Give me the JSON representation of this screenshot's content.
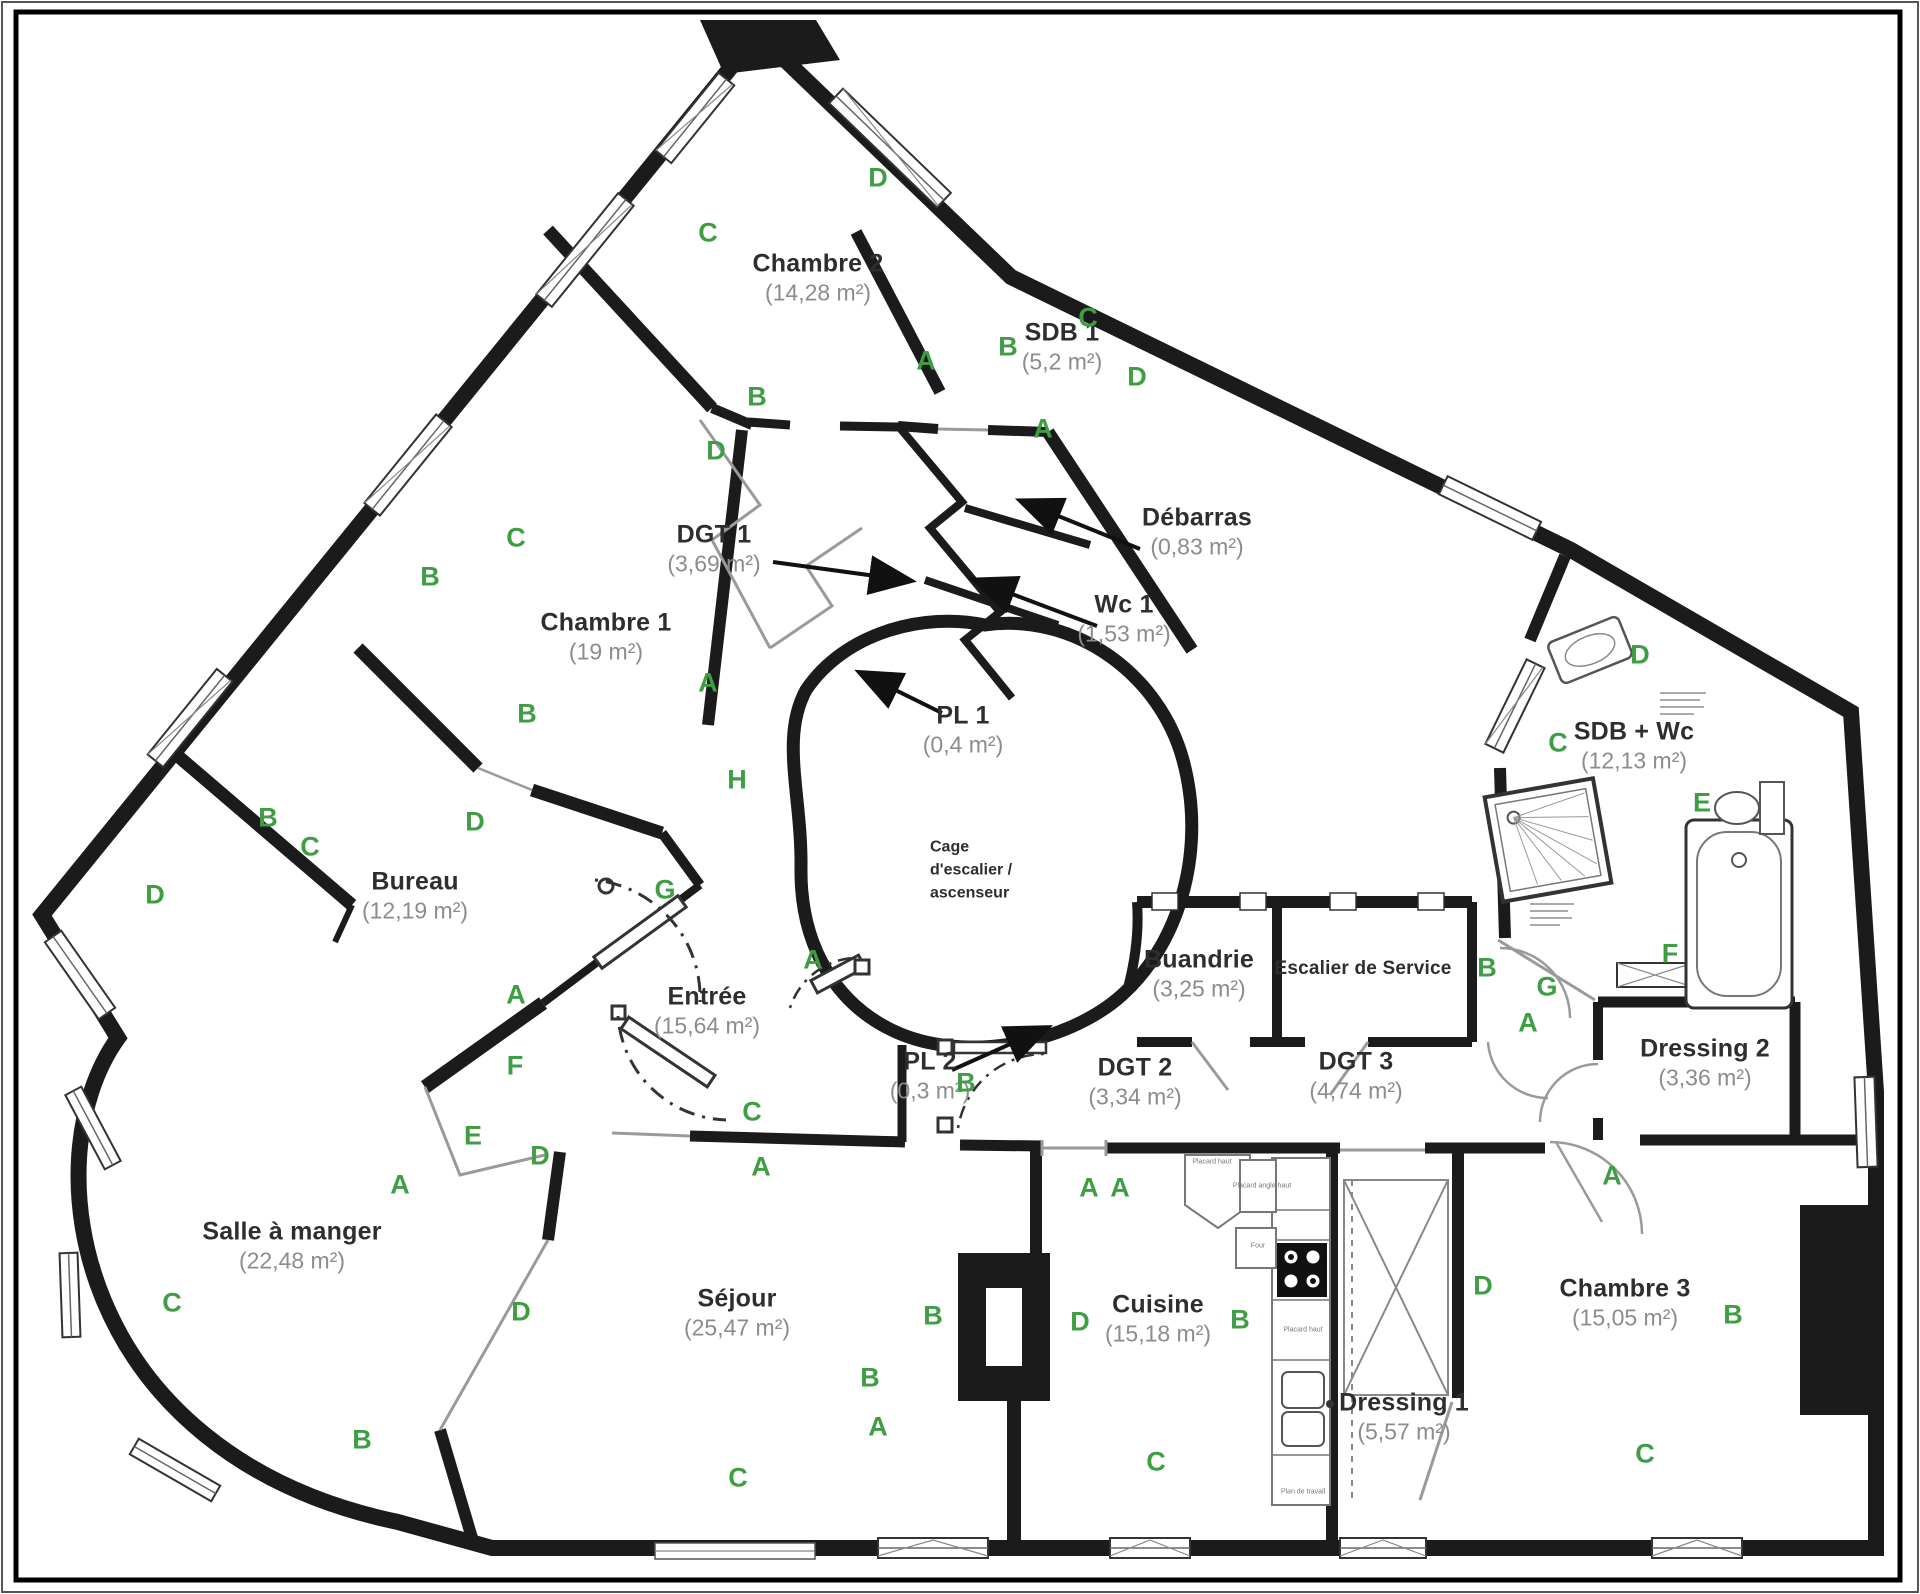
{
  "plan": {
    "title": "Plan d'appartement",
    "colors": {
      "wall": "#1b1b1b",
      "thin_line": "#999999",
      "letter_green": "#3f9e44",
      "room_title": "#2e2e2e",
      "room_area": "#8c8c8c",
      "arrow": "#111111"
    }
  },
  "stair_core": {
    "lines": [
      "Cage",
      "d'escalier /",
      "ascenseur"
    ],
    "x": 930,
    "y": 870
  },
  "rooms": [
    {
      "name": "Chambre 2",
      "area": "(14,28 m²)",
      "x": 818,
      "y": 278
    },
    {
      "name": "SDB 1",
      "area": "(5,2 m²)",
      "x": 1062,
      "y": 347
    },
    {
      "name": "Chambre 1",
      "area": "(19 m²)",
      "x": 606,
      "y": 637
    },
    {
      "name": "DGT 1",
      "area": "(3,69 m²)",
      "x": 714,
      "y": 549
    },
    {
      "name": "Débarras",
      "area": "(0,83 m²)",
      "x": 1197,
      "y": 532
    },
    {
      "name": "Wc 1",
      "area": "(1,53 m²)",
      "x": 1124,
      "y": 619
    },
    {
      "name": "PL 1",
      "area": "(0,4 m²)",
      "x": 963,
      "y": 730
    },
    {
      "name": "SDB + Wc",
      "area": "(12,13 m²)",
      "x": 1634,
      "y": 746
    },
    {
      "name": "Bureau",
      "area": "(12,19 m²)",
      "x": 415,
      "y": 896
    },
    {
      "name": "Entrée",
      "area": "(15,64 m²)",
      "x": 707,
      "y": 1011
    },
    {
      "name": "Buandrie",
      "area": "(3,25 m²)",
      "x": 1199,
      "y": 974
    },
    {
      "name": "Escalier de Service",
      "area": "",
      "x": 1363,
      "y": 969,
      "small": true
    },
    {
      "name": "PL 2",
      "area": "(0,3 m²)",
      "x": 930,
      "y": 1076
    },
    {
      "name": "DGT 2",
      "area": "(3,34 m²)",
      "x": 1135,
      "y": 1082
    },
    {
      "name": "DGT 3",
      "area": "(4,74 m²)",
      "x": 1356,
      "y": 1076
    },
    {
      "name": "Dressing 2",
      "area": "(3,36 m²)",
      "x": 1705,
      "y": 1063
    },
    {
      "name": "Salle à manger",
      "area": "(22,48 m²)",
      "x": 292,
      "y": 1246
    },
    {
      "name": "Séjour",
      "area": "(25,47 m²)",
      "x": 737,
      "y": 1313
    },
    {
      "name": "Cuisine",
      "area": "(15,18 m²)",
      "x": 1158,
      "y": 1319
    },
    {
      "name": "Dressing 1",
      "area": "(5,57 m²)",
      "x": 1404,
      "y": 1417
    },
    {
      "name": "Chambre 3",
      "area": "(15,05 m²)",
      "x": 1625,
      "y": 1303
    }
  ],
  "letters": [
    {
      "t": "D",
      "x": 878,
      "y": 178
    },
    {
      "t": "C",
      "x": 708,
      "y": 233
    },
    {
      "t": "B",
      "x": 757,
      "y": 397
    },
    {
      "t": "A",
      "x": 926,
      "y": 361
    },
    {
      "t": "B",
      "x": 1008,
      "y": 347
    },
    {
      "t": "C",
      "x": 1088,
      "y": 318
    },
    {
      "t": "D",
      "x": 1137,
      "y": 377
    },
    {
      "t": "A",
      "x": 1043,
      "y": 429
    },
    {
      "t": "D",
      "x": 716,
      "y": 451
    },
    {
      "t": "C",
      "x": 516,
      "y": 538
    },
    {
      "t": "B",
      "x": 430,
      "y": 577
    },
    {
      "t": "A",
      "x": 708,
      "y": 683
    },
    {
      "t": "B",
      "x": 527,
      "y": 714
    },
    {
      "t": "H",
      "x": 737,
      "y": 780
    },
    {
      "t": "C",
      "x": 310,
      "y": 847
    },
    {
      "t": "D",
      "x": 475,
      "y": 822
    },
    {
      "t": "G",
      "x": 665,
      "y": 890
    },
    {
      "t": "B",
      "x": 268,
      "y": 818
    },
    {
      "t": "D",
      "x": 155,
      "y": 895
    },
    {
      "t": "A",
      "x": 516,
      "y": 995
    },
    {
      "t": "F",
      "x": 515,
      "y": 1066
    },
    {
      "t": "E",
      "x": 473,
      "y": 1136
    },
    {
      "t": "D",
      "x": 540,
      "y": 1156
    },
    {
      "t": "A",
      "x": 813,
      "y": 960
    },
    {
      "t": "C",
      "x": 752,
      "y": 1112
    },
    {
      "t": "A",
      "x": 761,
      "y": 1167
    },
    {
      "t": "B",
      "x": 966,
      "y": 1083
    },
    {
      "t": "A",
      "x": 1089,
      "y": 1188
    },
    {
      "t": "B",
      "x": 1487,
      "y": 968
    },
    {
      "t": "G",
      "x": 1547,
      "y": 987
    },
    {
      "t": "A",
      "x": 1528,
      "y": 1023
    },
    {
      "t": "F",
      "x": 1670,
      "y": 954
    },
    {
      "t": "D",
      "x": 1640,
      "y": 655
    },
    {
      "t": "C",
      "x": 1558,
      "y": 743
    },
    {
      "t": "E",
      "x": 1702,
      "y": 803
    },
    {
      "t": "A",
      "x": 400,
      "y": 1185
    },
    {
      "t": "C",
      "x": 172,
      "y": 1303
    },
    {
      "t": "D",
      "x": 521,
      "y": 1312
    },
    {
      "t": "B",
      "x": 362,
      "y": 1440
    },
    {
      "t": "B",
      "x": 933,
      "y": 1316
    },
    {
      "t": "B",
      "x": 870,
      "y": 1378
    },
    {
      "t": "A",
      "x": 878,
      "y": 1427
    },
    {
      "t": "C",
      "x": 738,
      "y": 1478
    },
    {
      "t": "D",
      "x": 1080,
      "y": 1322
    },
    {
      "t": "A",
      "x": 1120,
      "y": 1188
    },
    {
      "t": "B",
      "x": 1240,
      "y": 1320
    },
    {
      "t": "C",
      "x": 1156,
      "y": 1462
    },
    {
      "t": "A",
      "x": 1612,
      "y": 1176
    },
    {
      "t": "D",
      "x": 1483,
      "y": 1286
    },
    {
      "t": "B",
      "x": 1733,
      "y": 1315
    },
    {
      "t": "C",
      "x": 1645,
      "y": 1454
    }
  ],
  "kitchen_labels": [
    {
      "t": "Placard haut",
      "x": 1212,
      "y": 1162
    },
    {
      "t": "Placard angle haut",
      "x": 1262,
      "y": 1186
    },
    {
      "t": "Four",
      "x": 1258,
      "y": 1246
    },
    {
      "t": "Placard haut",
      "x": 1303,
      "y": 1330
    },
    {
      "t": "Plan de travail",
      "x": 1303,
      "y": 1492
    }
  ]
}
